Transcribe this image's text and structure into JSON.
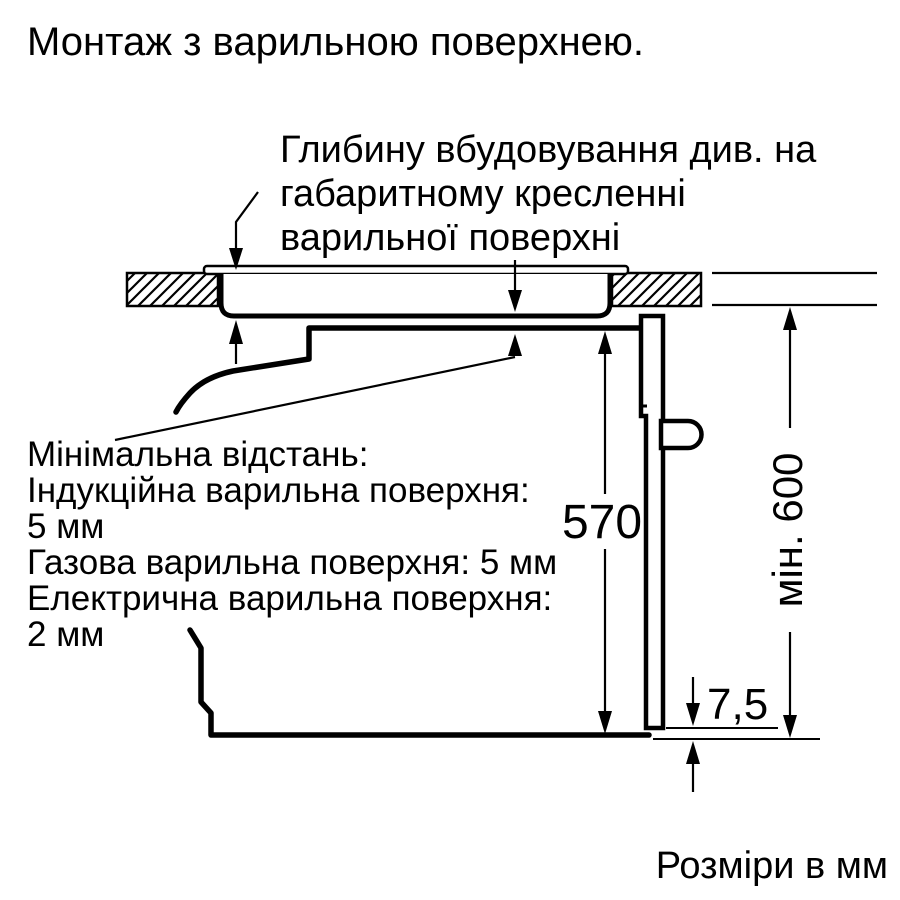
{
  "title": "Монтаж з варильною поверхнею.",
  "colors": {
    "ink": "#000000",
    "background": "#ffffff"
  },
  "depth_note": {
    "lines": [
      "Глибину вбудовування див. на",
      "габаритному кресленні",
      "варильної поверхні"
    ]
  },
  "min_distance_note": {
    "lines": [
      "Мінімальна відстань:",
      "Індукційна варильна поверхня:",
      "5 мм",
      "Газова варильна поверхня: 5 мм",
      "Електрична варильна поверхня:",
      "2 мм"
    ]
  },
  "dimensions": {
    "oven_height_mm": "570",
    "worktop_min_height_mm": "мін. 600",
    "bottom_gap_mm": "7,5"
  },
  "footer": {
    "units_label": "Розміри в мм"
  }
}
